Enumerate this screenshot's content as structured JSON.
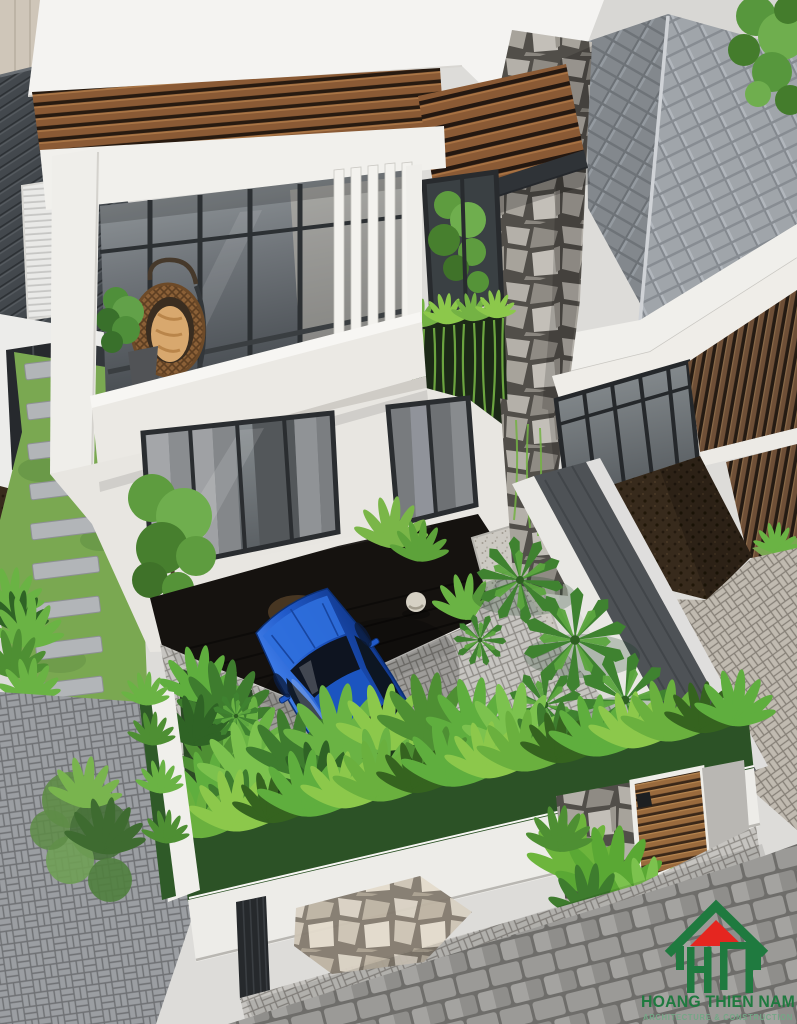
{
  "image": {
    "kind": "3D exterior architectural render",
    "view": "aerial three-quarter top-down view",
    "width_px": 797,
    "height_px": 1024,
    "subject": "Modern two-storey white townhouse with wood-slat screens, stone-clad column, glazed balcony with hanging egg chair, front courtyard with blue sports car, palm and tropical planting, white perimeter wall with timber gate, neighbouring grey tiled-roof houses"
  },
  "watermark": {
    "brand_name": "HOANG THIEN NAM",
    "tagline": "ARCHITECTURE & CONSTRUCTION",
    "logo_icon": "green gable-house outline with red roof triangle and stylised H-N letterforms"
  },
  "scene_objects": [
    "street-pavement-top-right",
    "corner-tree",
    "grey-tile-roof",
    "dark-metal-roof-left",
    "white-flat-roof",
    "wood-slat-band",
    "wood-slat-canopy",
    "stone-clad-column",
    "balcony-glazing",
    "white-louver-fins",
    "hanging-egg-chair",
    "balcony-plant",
    "courtyard-window-with-tree",
    "green-vine-wall",
    "ground-floor-windows-with-curtains",
    "black-granite-porch",
    "terrazzo-walkway",
    "front-left-tree",
    "neighbour-glass-doors",
    "neighbour-wood-slat-wall",
    "neighbour-soil-yard",
    "neighbour-paved-yard",
    "concrete-boundary-wall",
    "courtyard-pavers",
    "blue-sports-car",
    "palm-cluster",
    "tropical-shrub-beds",
    "garden-light-ball",
    "perimeter-hedge",
    "white-perimeter-wall",
    "stone-gate-pillar",
    "timber-gate-door",
    "dark-gate-panel",
    "driveway-apron",
    "flagstone-patch",
    "cobblestone-sidewalk",
    "side-alley-stepping-stones",
    "brand-watermark"
  ],
  "colors": {
    "logo_green": "#1f7a3f",
    "logo_red": "#e52620",
    "logo_tagline": "#74a786",
    "white_wall": "#efeee9",
    "wood_slat_brown": "#8a5a35",
    "roof_tile_gray": "#a0a5aa",
    "metal_roof_gray": "#43484d",
    "stone_gray": "#a7a39b",
    "glass_dark": "#43484d",
    "curtain_gray": "#9fa1a4",
    "paver_light_gray": "#c6c4c0",
    "cobble_gray": "#8f8e8b",
    "granite_black": "#15120f",
    "soil_brown": "#372a1c",
    "grass_green": "#7aa851",
    "hedge_green": "#2c5226",
    "foliage_bright_green": "#5fae3e",
    "palm_green": "#3f8230",
    "vine_green": "#74b244",
    "car_blue": "#2059c8",
    "concrete_gray": "#4e5256",
    "road_gray": "#d8d7d4",
    "beige_wall": "#cfc6b9"
  }
}
